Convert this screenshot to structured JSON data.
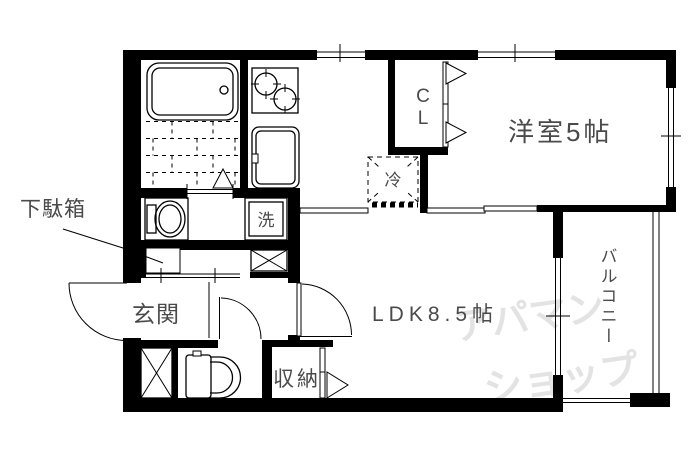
{
  "floorplan": {
    "type": "apartment-floor-plan",
    "rooms": {
      "living_dining_kitchen": {
        "label": "LDK8.5帖"
      },
      "western_room": {
        "label": "洋室5帖"
      },
      "entrance": {
        "label": "玄関"
      },
      "balcony": {
        "label": "バルコニー"
      },
      "storage": {
        "label": "収納"
      },
      "closet": {
        "label_chars": [
          "C",
          "L"
        ]
      },
      "refrigerator_space": {
        "label": "冷"
      },
      "washing_machine_space": {
        "label": "洗"
      },
      "shoe_cabinet": {
        "label": "下駄箱"
      }
    },
    "watermark": {
      "line1": "アパマン",
      "line2": "ショップ"
    },
    "colors": {
      "wall": "#000000",
      "label": "#4a4a4a",
      "watermark": "#e3e3e3",
      "background": "#ffffff"
    },
    "fixtures": [
      "bathtub",
      "tile-floor",
      "gas-stove",
      "kitchen-sink",
      "wash-basin",
      "toilet",
      "pipe-space",
      "shoe-cabinet",
      "refrigerator-space",
      "washing-machine-space",
      "closet-bifold-door",
      "storage-bifold-door",
      "bathroom-folding-door",
      "entrance-door",
      "ldk-door",
      "toilet-door",
      "sliding-door",
      "balcony-railing",
      "window"
    ]
  }
}
